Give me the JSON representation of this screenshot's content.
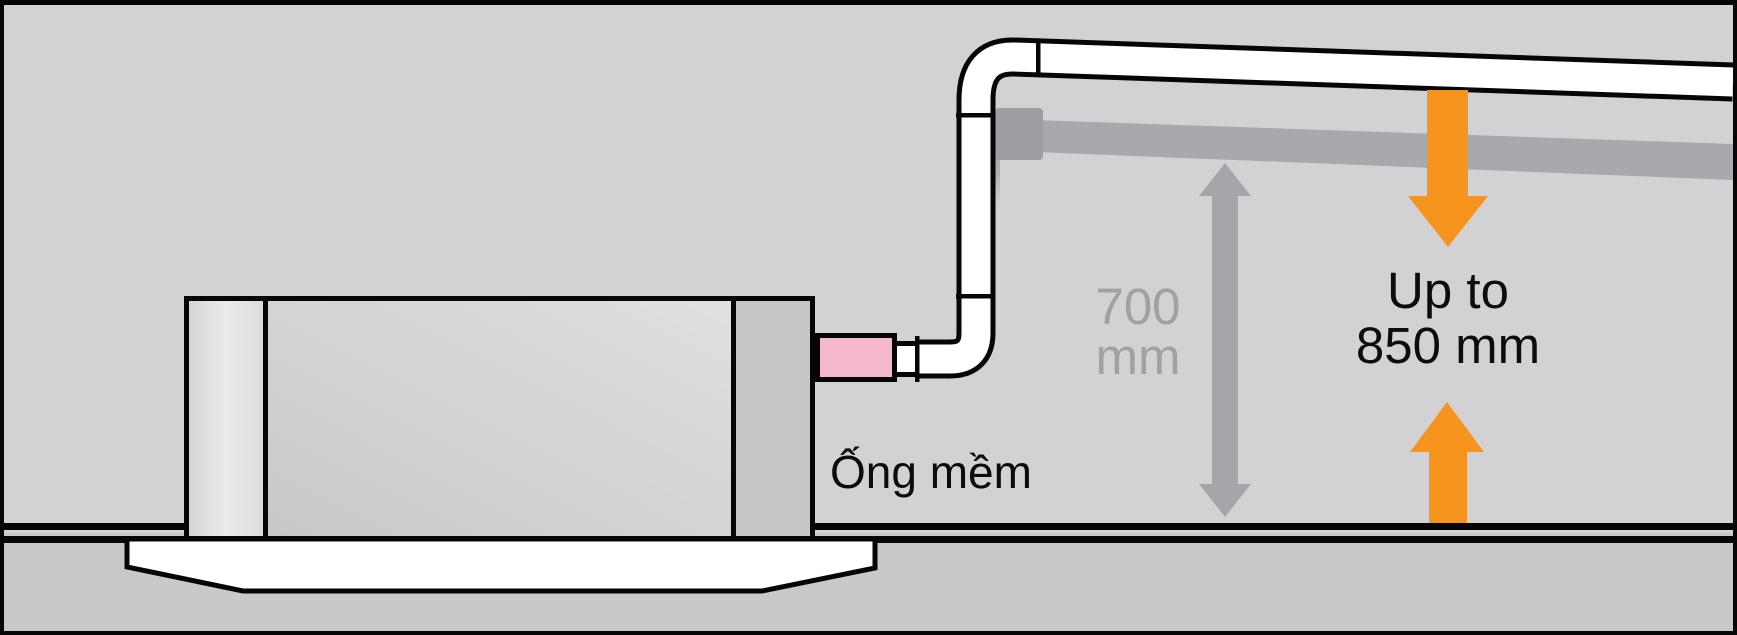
{
  "diagram": {
    "labels": {
      "flexible_hose": "Ống mềm",
      "clearance": {
        "line1": "700",
        "line2": "mm"
      },
      "drain_lift": {
        "line1": "Up to",
        "line2": "850 mm"
      }
    },
    "icons": {
      "down_arrow": "orange-down-arrow",
      "up_arrow": "orange-up-arrow",
      "measure_arrow": "gray-double-headed-arrow"
    },
    "colors": {
      "background_upper": "#d2d2d5",
      "background_lower": "#c9c9cc",
      "outline": "#060606",
      "orange_arrow": "#f7941e",
      "flexible_hose_pink": "#f5b7cc",
      "gray_pipe": "#a9a9ad",
      "gray_coupling": "#9d9da2",
      "gray_text": "#a1a1a5",
      "gray_measure_arrow": "#a6a6aa",
      "label_black": "#0c0c0c"
    }
  }
}
